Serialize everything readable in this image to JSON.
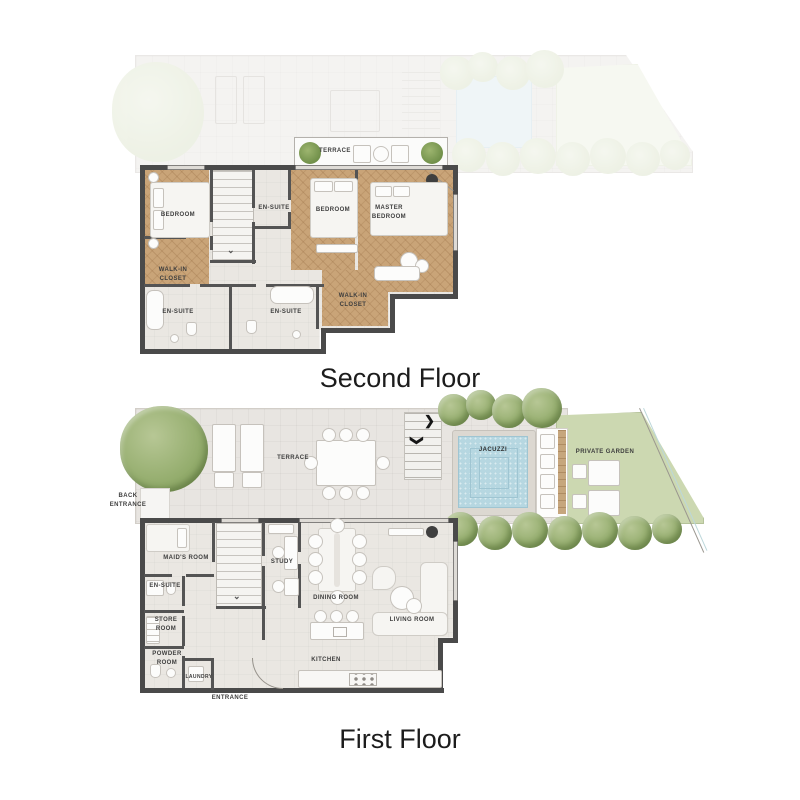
{
  "page": {
    "background": "#ffffff"
  },
  "palette": {
    "floor": "#eae7e2",
    "terrace": "#e8e5e1",
    "wall": "#4a4a4a",
    "wood_floor": "#c9a478",
    "water": "#b6d7e1",
    "garden": "#ccd8b1",
    "tree": "#93ac6c",
    "label_text": "#3e3e3e",
    "title_text": "#1c1c1c"
  },
  "icons": {
    "stair_arrow_right": "❯",
    "stair_arrow_down": "❯",
    "stair_direction": "⌄"
  },
  "second_floor": {
    "title": "Second Floor",
    "labels": {
      "terrace": "TERRACE",
      "bedroom_left": "BEDROOM",
      "ensuite_top": "EN-SUITE",
      "bedroom_center": "BEDROOM",
      "master_bedroom": "MASTER BEDROOM",
      "walkin_left": "WALK-IN CLOSET",
      "ensuite_bottom_left": "EN-SUITE",
      "ensuite_bottom_center": "EN-SUITE",
      "walkin_right": "WALK-IN CLOSET"
    }
  },
  "first_floor": {
    "title": "First Floor",
    "labels": {
      "back_entrance": "BACK ENTRANCE",
      "terrace": "TERRACE",
      "jacuzzi": "JACUZZI",
      "private_garden": "PRIVATE GARDEN",
      "maids_room": "MAID'S ROOM",
      "ensuite": "EN-SUITE",
      "store_room": "STORE ROOM",
      "powder_room": "POWDER ROOM",
      "laundry": "LAUNDRY",
      "entrance": "ENTRANCE",
      "study": "STUDY",
      "dining_room": "DINING ROOM",
      "living_room": "LIVING ROOM",
      "kitchen": "KITCHEN"
    }
  }
}
